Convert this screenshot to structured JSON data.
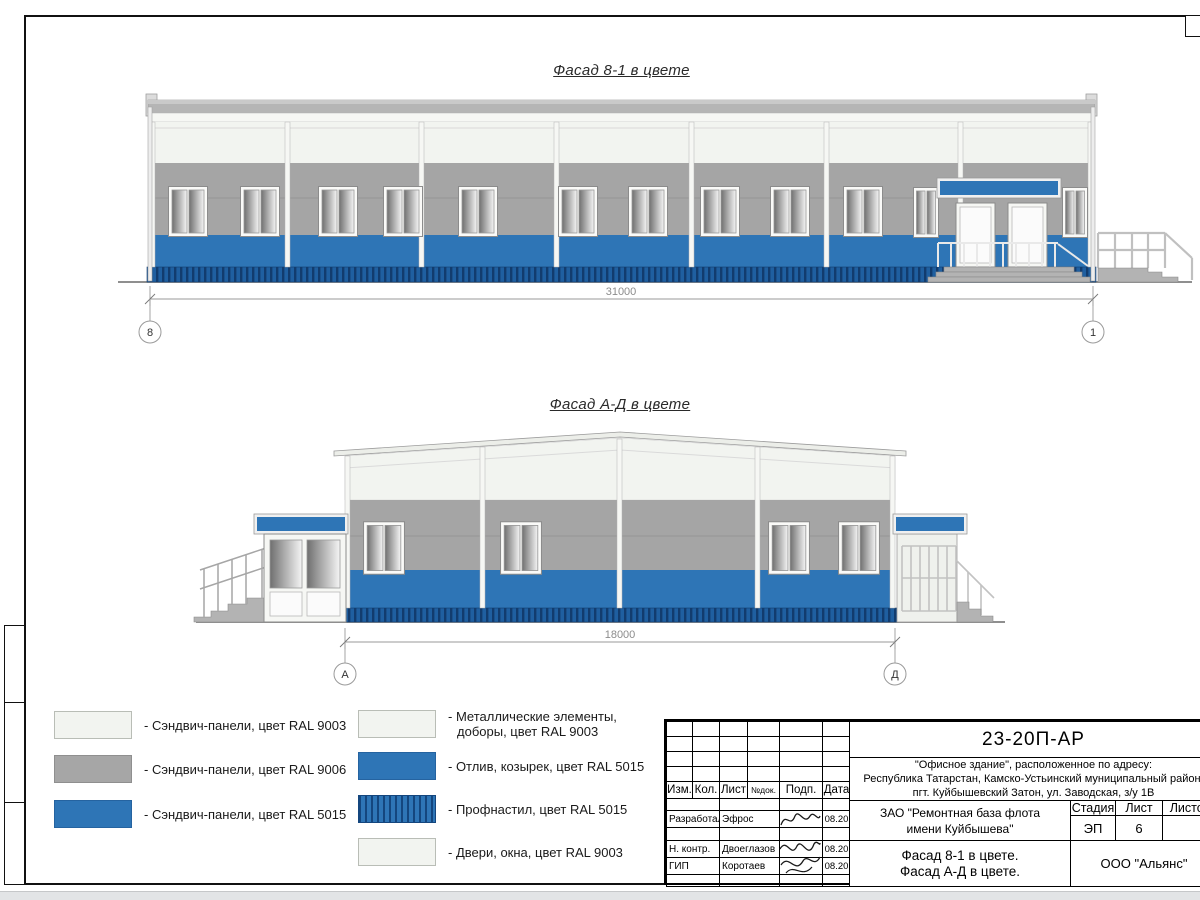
{
  "drawing": {
    "facade1": {
      "title": "Фасад 8-1 в цвете",
      "dimension": "31000",
      "axis_left": "8",
      "axis_right": "1"
    },
    "facade2": {
      "title": "Фасад А-Д в цвете",
      "dimension": "18000",
      "axis_left": "А",
      "axis_right": "Д"
    }
  },
  "legend": {
    "col1": [
      {
        "label": "- Сэндвич-панели, цвет RAL 9003"
      },
      {
        "label": "- Сэндвич-панели, цвет RAL 9006"
      },
      {
        "label": "- Сэндвич-панели, цвет RAL 5015"
      }
    ],
    "col2": [
      {
        "line1": "- Металлические элементы,",
        "line2": "доборы, цвет RAL 9003"
      },
      {
        "label": "- Отлив, козырек, цвет RAL 5015"
      },
      {
        "label": "- Профнастил, цвет RAL 5015"
      },
      {
        "label": "- Двери, окна, цвет RAL 9003"
      }
    ]
  },
  "colors": {
    "ral9003_white": "#f2f4f0",
    "ral9006_gray": "#a6a6a6",
    "ral5015_blue": "#2e75b6",
    "profnastil_stripe": "#14467e"
  },
  "title_block": {
    "code": "23-20П-АР",
    "address_line1": "\"Офисное здание\", расположенное по адресу:",
    "address_line2": "Республика Татарстан, Камско-Устьинский муниципальный район,",
    "address_line3": "пгт. Куйбышевский Затон, ул. Заводская, з/у 1В",
    "col_izm": "Изм.",
    "col_kol": "Кол.",
    "col_list": "Лист",
    "col_ndok": "№док.",
    "col_podp": "Подп.",
    "col_data": "Дата",
    "row_developed_role": "Разработал",
    "row_developed_name": "Эфрос",
    "row_developed_date": "08.20",
    "row_ncontr_role": "Н. контр.",
    "row_ncontr_name": "Двоеглазов",
    "row_ncontr_date": "08.20",
    "row_gip_role": "ГИП",
    "row_gip_name": "Коротаев",
    "row_gip_date": "08.20",
    "client_line1": "ЗАО \"Ремонтная база флота",
    "client_line2": "имени Куйбышева\"",
    "stage_label": "Стадия",
    "sheet_label": "Лист",
    "sheets_label": "Листов",
    "stage_value": "ЭП",
    "sheet_value": "6",
    "subject_line1": "Фасад 8-1 в цвете.",
    "subject_line2": "Фасад А-Д в цвете.",
    "contractor": "ООО \"Альянс\""
  }
}
